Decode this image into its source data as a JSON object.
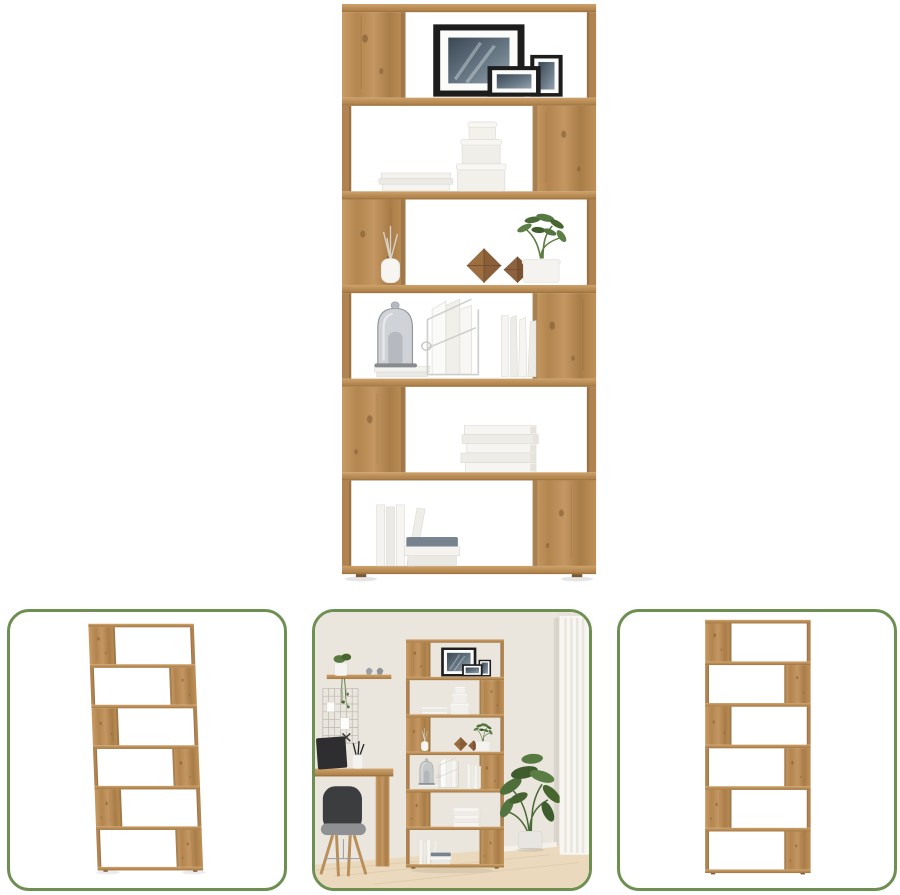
{
  "colors": {
    "background": "#ffffff",
    "accent_green": "#6d8f52",
    "wood_light": "#c89b64",
    "wood_mid": "#b3854f",
    "wood_dark": "#8a6336"
  },
  "gallery": {
    "hero": {
      "name": "bookshelf-hero",
      "alt": "Six-tier zig-zag bookcase in artisan oak decorated with picture frames, round boxes, plants, a bell jar and books"
    },
    "thumbnails": [
      {
        "name": "thumbnail-angled-view",
        "alt": "Bookcase shown empty from an angle"
      },
      {
        "name": "thumbnail-lifestyle-view",
        "alt": "Bookcase styled in a home office next to a desk, chair and plant"
      },
      {
        "name": "thumbnail-front-view",
        "alt": "Bookcase shown empty from the front"
      }
    ]
  }
}
